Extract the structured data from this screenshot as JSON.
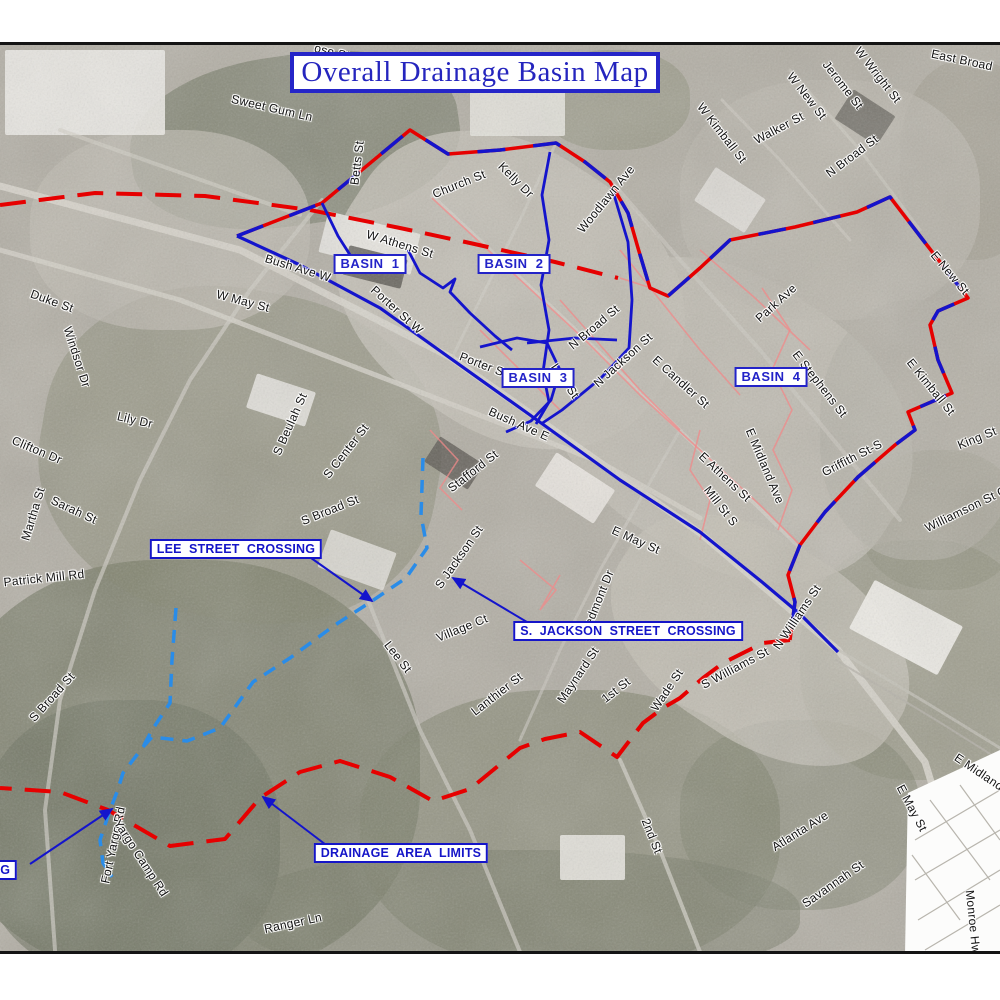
{
  "title": "Overall Drainage Basin Map",
  "colors": {
    "boundary_red": "#e60000",
    "boundary_blue": "#1414cc",
    "stream_blue": "#1414cc",
    "storm_cyan": "#2a8ce8",
    "network_pink": "#f08a8a",
    "label_blue": "#1515c8",
    "street_text": "#141414",
    "frame_black": "#141414"
  },
  "basin_labels": [
    {
      "label": "BASIN  1",
      "x": 370,
      "y": 264
    },
    {
      "label": "BASIN  2",
      "x": 514,
      "y": 264
    },
    {
      "label": "BASIN  3",
      "x": 538,
      "y": 378
    },
    {
      "label": "BASIN  4",
      "x": 771,
      "y": 377
    }
  ],
  "callouts": [
    {
      "label": "LEE  STREET  CROSSING",
      "cx": 236,
      "cy": 549,
      "from": [
        304,
        553
      ],
      "tip": [
        372,
        601
      ],
      "clipped": false
    },
    {
      "label": "S.  JACKSON  STREET  CROSSING",
      "cx": 628,
      "cy": 631,
      "from": [
        537,
        628
      ],
      "tip": [
        453,
        578
      ],
      "clipped": false
    },
    {
      "label": "DRAINAGE  AREA  LIMITS",
      "cx": 401,
      "cy": 853,
      "from": [
        334,
        851
      ],
      "tip": [
        263,
        797
      ],
      "clipped": false
    },
    {
      "label": "SING",
      "cx": -18,
      "cy": 870,
      "from": [
        30,
        864
      ],
      "tip": [
        112,
        809
      ],
      "clipped": true
    }
  ],
  "street_labels": [
    {
      "text": "ose St",
      "x": 332,
      "y": 52,
      "rot": 14
    },
    {
      "text": "Sweet Gum Ln",
      "x": 272,
      "y": 108,
      "rot": 13
    },
    {
      "text": "Betts St",
      "x": 357,
      "y": 163,
      "rot": -83
    },
    {
      "text": "Church St",
      "x": 459,
      "y": 184,
      "rot": -22
    },
    {
      "text": "Kelly Dr",
      "x": 516,
      "y": 180,
      "rot": 45
    },
    {
      "text": "Woodlawn Ave",
      "x": 606,
      "y": 199,
      "rot": -51
    },
    {
      "text": "W Athens St",
      "x": 400,
      "y": 244,
      "rot": 17
    },
    {
      "text": "Bush Ave W",
      "x": 298,
      "y": 268,
      "rot": 17
    },
    {
      "text": "W May St",
      "x": 243,
      "y": 301,
      "rot": 15
    },
    {
      "text": "Duke St",
      "x": 52,
      "y": 301,
      "rot": 20
    },
    {
      "text": "Windsor Dr",
      "x": 77,
      "y": 357,
      "rot": 72
    },
    {
      "text": "Lily Dr",
      "x": 135,
      "y": 420,
      "rot": 13
    },
    {
      "text": "Clifton Dr",
      "x": 37,
      "y": 450,
      "rot": 23
    },
    {
      "text": "Martha St",
      "x": 33,
      "y": 514,
      "rot": -73
    },
    {
      "text": "Sarah St",
      "x": 74,
      "y": 510,
      "rot": 25
    },
    {
      "text": "Patrick Mill Rd",
      "x": 44,
      "y": 578,
      "rot": -6
    },
    {
      "text": "S Beulah St",
      "x": 290,
      "y": 424,
      "rot": -66
    },
    {
      "text": "S Center St",
      "x": 346,
      "y": 451,
      "rot": -52
    },
    {
      "text": "S Broad St",
      "x": 330,
      "y": 510,
      "rot": -22
    },
    {
      "text": "Stafford St",
      "x": 473,
      "y": 471,
      "rot": -38
    },
    {
      "text": "Porter St W",
      "x": 397,
      "y": 310,
      "rot": 42
    },
    {
      "text": "Porter St E",
      "x": 489,
      "y": 367,
      "rot": 21
    },
    {
      "text": "Bush Ave E",
      "x": 519,
      "y": 424,
      "rot": 24
    },
    {
      "text": "Lula St",
      "x": 565,
      "y": 381,
      "rot": 55
    },
    {
      "text": "N Broad St",
      "x": 594,
      "y": 327,
      "rot": -40
    },
    {
      "text": "N Jackson St",
      "x": 623,
      "y": 360,
      "rot": -42
    },
    {
      "text": "E Candler St",
      "x": 681,
      "y": 382,
      "rot": 42
    },
    {
      "text": "E Athens St",
      "x": 725,
      "y": 477,
      "rot": 43
    },
    {
      "text": "Mill St S",
      "x": 721,
      "y": 506,
      "rot": 52
    },
    {
      "text": "E Midland Ave",
      "x": 765,
      "y": 466,
      "rot": 67
    },
    {
      "text": "Park Ave",
      "x": 776,
      "y": 303,
      "rot": -42
    },
    {
      "text": "E Stephens St",
      "x": 820,
      "y": 384,
      "rot": 52
    },
    {
      "text": "Griffith St-S",
      "x": 852,
      "y": 458,
      "rot": -27
    },
    {
      "text": "King St",
      "x": 977,
      "y": 438,
      "rot": -22
    },
    {
      "text": "E Kimball St",
      "x": 931,
      "y": 387,
      "rot": 51
    },
    {
      "text": "E New St",
      "x": 950,
      "y": 273,
      "rot": 50
    },
    {
      "text": "Williamson St Cap",
      "x": 972,
      "y": 506,
      "rot": -26
    },
    {
      "text": "W Kimball St",
      "x": 722,
      "y": 133,
      "rot": 52
    },
    {
      "text": "Walker St",
      "x": 779,
      "y": 128,
      "rot": -28
    },
    {
      "text": "W New St",
      "x": 807,
      "y": 96,
      "rot": 52
    },
    {
      "text": "Jerome St",
      "x": 843,
      "y": 85,
      "rot": 52
    },
    {
      "text": "W Wright St",
      "x": 878,
      "y": 75,
      "rot": 52
    },
    {
      "text": "N Broad St",
      "x": 852,
      "y": 156,
      "rot": -37
    },
    {
      "text": "East Broad",
      "x": 962,
      "y": 60,
      "rot": 12
    },
    {
      "text": "E May St",
      "x": 636,
      "y": 540,
      "rot": 24
    },
    {
      "text": "Piedmont Dr",
      "x": 597,
      "y": 603,
      "rot": -68
    },
    {
      "text": "S Jackson St",
      "x": 459,
      "y": 557,
      "rot": -55
    },
    {
      "text": "Village Ct",
      "x": 462,
      "y": 628,
      "rot": -22
    },
    {
      "text": "Lee St",
      "x": 398,
      "y": 657,
      "rot": 52
    },
    {
      "text": "Lanthier St",
      "x": 497,
      "y": 694,
      "rot": -38
    },
    {
      "text": "Maynard St",
      "x": 578,
      "y": 675,
      "rot": -56
    },
    {
      "text": "1st St",
      "x": 616,
      "y": 690,
      "rot": -38
    },
    {
      "text": "Wade St",
      "x": 667,
      "y": 690,
      "rot": -56
    },
    {
      "text": "S Williams St",
      "x": 735,
      "y": 668,
      "rot": -28
    },
    {
      "text": "N Williams St",
      "x": 797,
      "y": 617,
      "rot": -56
    },
    {
      "text": "2nd St",
      "x": 652,
      "y": 836,
      "rot": 68
    },
    {
      "text": "Atlanta Ave",
      "x": 800,
      "y": 831,
      "rot": -32
    },
    {
      "text": "Savannah St",
      "x": 833,
      "y": 884,
      "rot": -35
    },
    {
      "text": "Ranger Ln",
      "x": 293,
      "y": 923,
      "rot": -12
    },
    {
      "text": "S Broad St",
      "x": 52,
      "y": 697,
      "rot": -48
    },
    {
      "text": "Fort Yargo Rd",
      "x": 113,
      "y": 845,
      "rot": -78
    },
    {
      "text": "Yargo Camp Rd",
      "x": 141,
      "y": 858,
      "rot": 57
    }
  ],
  "inset": {
    "labels": [
      {
        "text": "E May St",
        "x": 912,
        "y": 808,
        "rot": 62
      },
      {
        "text": "E Midland",
        "x": 979,
        "y": 772,
        "rot": 34
      },
      {
        "text": "Monroe Hw",
        "x": 973,
        "y": 922,
        "rot": 84
      }
    ]
  },
  "lines": {
    "red_dash_nw": [
      [
        0,
        205
      ],
      [
        95,
        193
      ],
      [
        205,
        196
      ],
      [
        310,
        210
      ],
      [
        400,
        228
      ],
      [
        470,
        243
      ],
      [
        555,
        262
      ],
      [
        618,
        278
      ]
    ],
    "basin_boundary": [
      [
        237,
        236
      ],
      [
        322,
        203
      ],
      [
        410,
        130
      ],
      [
        448,
        154
      ],
      [
        500,
        150
      ],
      [
        556,
        143
      ],
      [
        585,
        162
      ],
      [
        610,
        182
      ],
      [
        628,
        213
      ],
      [
        638,
        248
      ],
      [
        650,
        288
      ],
      [
        668,
        296
      ],
      [
        700,
        268
      ],
      [
        730,
        240
      ],
      [
        795,
        227
      ],
      [
        857,
        212
      ],
      [
        890,
        197
      ],
      [
        923,
        240
      ],
      [
        968,
        298
      ],
      [
        938,
        311
      ],
      [
        930,
        325
      ],
      [
        938,
        360
      ],
      [
        952,
        393
      ],
      [
        908,
        412
      ],
      [
        915,
        430
      ],
      [
        895,
        445
      ],
      [
        858,
        477
      ],
      [
        825,
        512
      ],
      [
        800,
        545
      ],
      [
        788,
        575
      ],
      [
        795,
        602
      ],
      [
        790,
        640
      ]
    ],
    "red_dash_south": [
      [
        790,
        640
      ],
      [
        763,
        643
      ],
      [
        745,
        652
      ],
      [
        723,
        663
      ],
      [
        703,
        678
      ],
      [
        680,
        698
      ],
      [
        663,
        708
      ],
      [
        643,
        723
      ],
      [
        617,
        757
      ],
      [
        580,
        732
      ],
      [
        545,
        739
      ],
      [
        520,
        748
      ],
      [
        470,
        789
      ],
      [
        433,
        801
      ],
      [
        390,
        777
      ],
      [
        340,
        761
      ],
      [
        300,
        772
      ],
      [
        260,
        798
      ],
      [
        225,
        839
      ],
      [
        170,
        846
      ],
      [
        108,
        810
      ],
      [
        60,
        792
      ],
      [
        0,
        788
      ]
    ],
    "streams": [
      [
        [
          237,
          236
        ],
        [
          300,
          265
        ],
        [
          380,
          308
        ],
        [
          450,
          358
        ],
        [
          530,
          415
        ],
        [
          620,
          480
        ],
        [
          700,
          532
        ],
        [
          762,
          582
        ],
        [
          800,
          614
        ],
        [
          838,
          652
        ]
      ],
      [
        [
          408,
          250
        ],
        [
          420,
          273
        ],
        [
          443,
          288
        ],
        [
          455,
          279
        ],
        [
          450,
          292
        ],
        [
          470,
          313
        ],
        [
          495,
          336
        ],
        [
          512,
          350
        ]
      ],
      [
        [
          550,
          152
        ],
        [
          542,
          195
        ],
        [
          549,
          240
        ],
        [
          541,
          285
        ],
        [
          549,
          330
        ],
        [
          543,
          372
        ],
        [
          549,
          402
        ],
        [
          536,
          424
        ]
      ],
      [
        [
          612,
          188
        ],
        [
          628,
          242
        ],
        [
          632,
          300
        ],
        [
          629,
          348
        ],
        [
          601,
          378
        ],
        [
          562,
          410
        ],
        [
          541,
          424
        ]
      ],
      [
        [
          480,
          347
        ],
        [
          517,
          338
        ],
        [
          547,
          343
        ],
        [
          560,
          370
        ],
        [
          551,
          400
        ],
        [
          531,
          421
        ],
        [
          506,
          432
        ]
      ],
      [
        [
          527,
          343
        ],
        [
          575,
          338
        ],
        [
          617,
          340
        ]
      ],
      [
        [
          322,
          203
        ],
        [
          338,
          236
        ],
        [
          352,
          258
        ],
        [
          376,
          272
        ]
      ]
    ],
    "storm_dashed": [
      [
        [
          423,
          458
        ],
        [
          421,
          515
        ],
        [
          427,
          548
        ],
        [
          406,
          578
        ],
        [
          372,
          601
        ],
        [
          335,
          625
        ],
        [
          290,
          658
        ],
        [
          253,
          682
        ],
        [
          220,
          728
        ],
        [
          187,
          741
        ],
        [
          152,
          737
        ],
        [
          143,
          747
        ],
        [
          123,
          773
        ],
        [
          117,
          792
        ],
        [
          110,
          810
        ],
        [
          100,
          840
        ],
        [
          103,
          863
        ],
        [
          112,
          877
        ]
      ],
      [
        [
          176,
          608
        ],
        [
          172,
          660
        ],
        [
          170,
          703
        ],
        [
          152,
          730
        ],
        [
          143,
          747
        ]
      ]
    ],
    "pink_network": [
      [
        [
          432,
          198
        ],
        [
          515,
          275
        ],
        [
          585,
          340
        ],
        [
          640,
          395
        ],
        [
          700,
          450
        ],
        [
          760,
          505
        ],
        [
          800,
          545
        ]
      ],
      [
        [
          560,
          300
        ],
        [
          600,
          345
        ],
        [
          640,
          390
        ],
        [
          680,
          430
        ]
      ],
      [
        [
          620,
          250
        ],
        [
          660,
          300
        ],
        [
          700,
          350
        ],
        [
          740,
          395
        ]
      ],
      [
        [
          700,
          250
        ],
        [
          755,
          298
        ],
        [
          810,
          350
        ]
      ],
      [
        [
          480,
          330
        ],
        [
          520,
          370
        ],
        [
          560,
          410
        ]
      ],
      [
        [
          520,
          560
        ],
        [
          556,
          590
        ],
        [
          540,
          610
        ],
        [
          560,
          575
        ]
      ],
      [
        [
          762,
          288
        ],
        [
          790,
          330
        ],
        [
          772,
          370
        ],
        [
          792,
          410
        ],
        [
          773,
          450
        ],
        [
          792,
          490
        ],
        [
          778,
          530
        ]
      ],
      [
        [
          430,
          430
        ],
        [
          458,
          460
        ],
        [
          440,
          488
        ],
        [
          462,
          510
        ]
      ],
      [
        [
          648,
          287
        ],
        [
          620,
          278
        ]
      ],
      [
        [
          700,
          430
        ],
        [
          690,
          470
        ],
        [
          710,
          500
        ],
        [
          700,
          540
        ]
      ]
    ]
  }
}
